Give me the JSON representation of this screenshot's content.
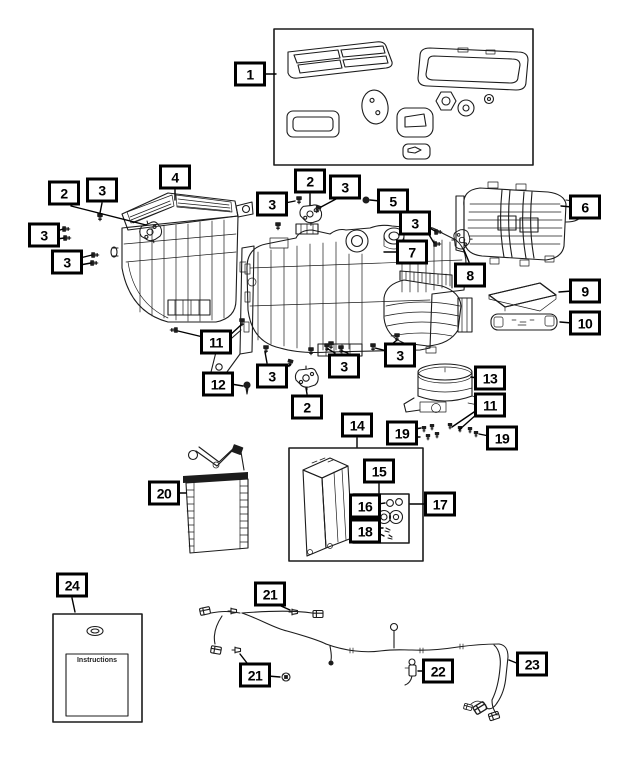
{
  "diagram": {
    "kind": "exploded-parts-diagram",
    "colors": {
      "background": "#ffffff",
      "line": "#1c1c1c",
      "callout_border": "#000000"
    }
  },
  "instruction_sheet": {
    "label": "Instructions"
  },
  "callouts": [
    {
      "label": "1",
      "x": 250,
      "y": 74
    },
    {
      "label": "4",
      "x": 175,
      "y": 177
    },
    {
      "label": "2",
      "x": 64,
      "y": 193
    },
    {
      "label": "3",
      "x": 102,
      "y": 190
    },
    {
      "label": "2",
      "x": 310,
      "y": 181
    },
    {
      "label": "3",
      "x": 272,
      "y": 204
    },
    {
      "label": "3",
      "x": 345,
      "y": 187
    },
    {
      "label": "5",
      "x": 393,
      "y": 201
    },
    {
      "label": "6",
      "x": 585,
      "y": 207
    },
    {
      "label": "3",
      "x": 415,
      "y": 223
    },
    {
      "label": "3",
      "x": 44,
      "y": 235
    },
    {
      "label": "7",
      "x": 412,
      "y": 252
    },
    {
      "label": "3",
      "x": 67,
      "y": 262
    },
    {
      "label": "8",
      "x": 470,
      "y": 275
    },
    {
      "label": "9",
      "x": 585,
      "y": 291
    },
    {
      "label": "10",
      "x": 585,
      "y": 323
    },
    {
      "label": "11",
      "x": 216,
      "y": 342
    },
    {
      "label": "3",
      "x": 272,
      "y": 376
    },
    {
      "label": "3",
      "x": 344,
      "y": 366
    },
    {
      "label": "3",
      "x": 400,
      "y": 355
    },
    {
      "label": "13",
      "x": 490,
      "y": 378
    },
    {
      "label": "12",
      "x": 218,
      "y": 384
    },
    {
      "label": "2",
      "x": 307,
      "y": 407
    },
    {
      "label": "11",
      "x": 490,
      "y": 405
    },
    {
      "label": "14",
      "x": 357,
      "y": 425
    },
    {
      "label": "19",
      "x": 402,
      "y": 433
    },
    {
      "label": "19",
      "x": 502,
      "y": 438
    },
    {
      "label": "15",
      "x": 379,
      "y": 471
    },
    {
      "label": "20",
      "x": 164,
      "y": 493
    },
    {
      "label": "16",
      "x": 365,
      "y": 506
    },
    {
      "label": "17",
      "x": 440,
      "y": 504
    },
    {
      "label": "18",
      "x": 365,
      "y": 531
    },
    {
      "label": "24",
      "x": 72,
      "y": 585
    },
    {
      "label": "21",
      "x": 270,
      "y": 594
    },
    {
      "label": "23",
      "x": 532,
      "y": 664
    },
    {
      "label": "22",
      "x": 438,
      "y": 671
    },
    {
      "label": "21",
      "x": 255,
      "y": 675
    }
  ]
}
